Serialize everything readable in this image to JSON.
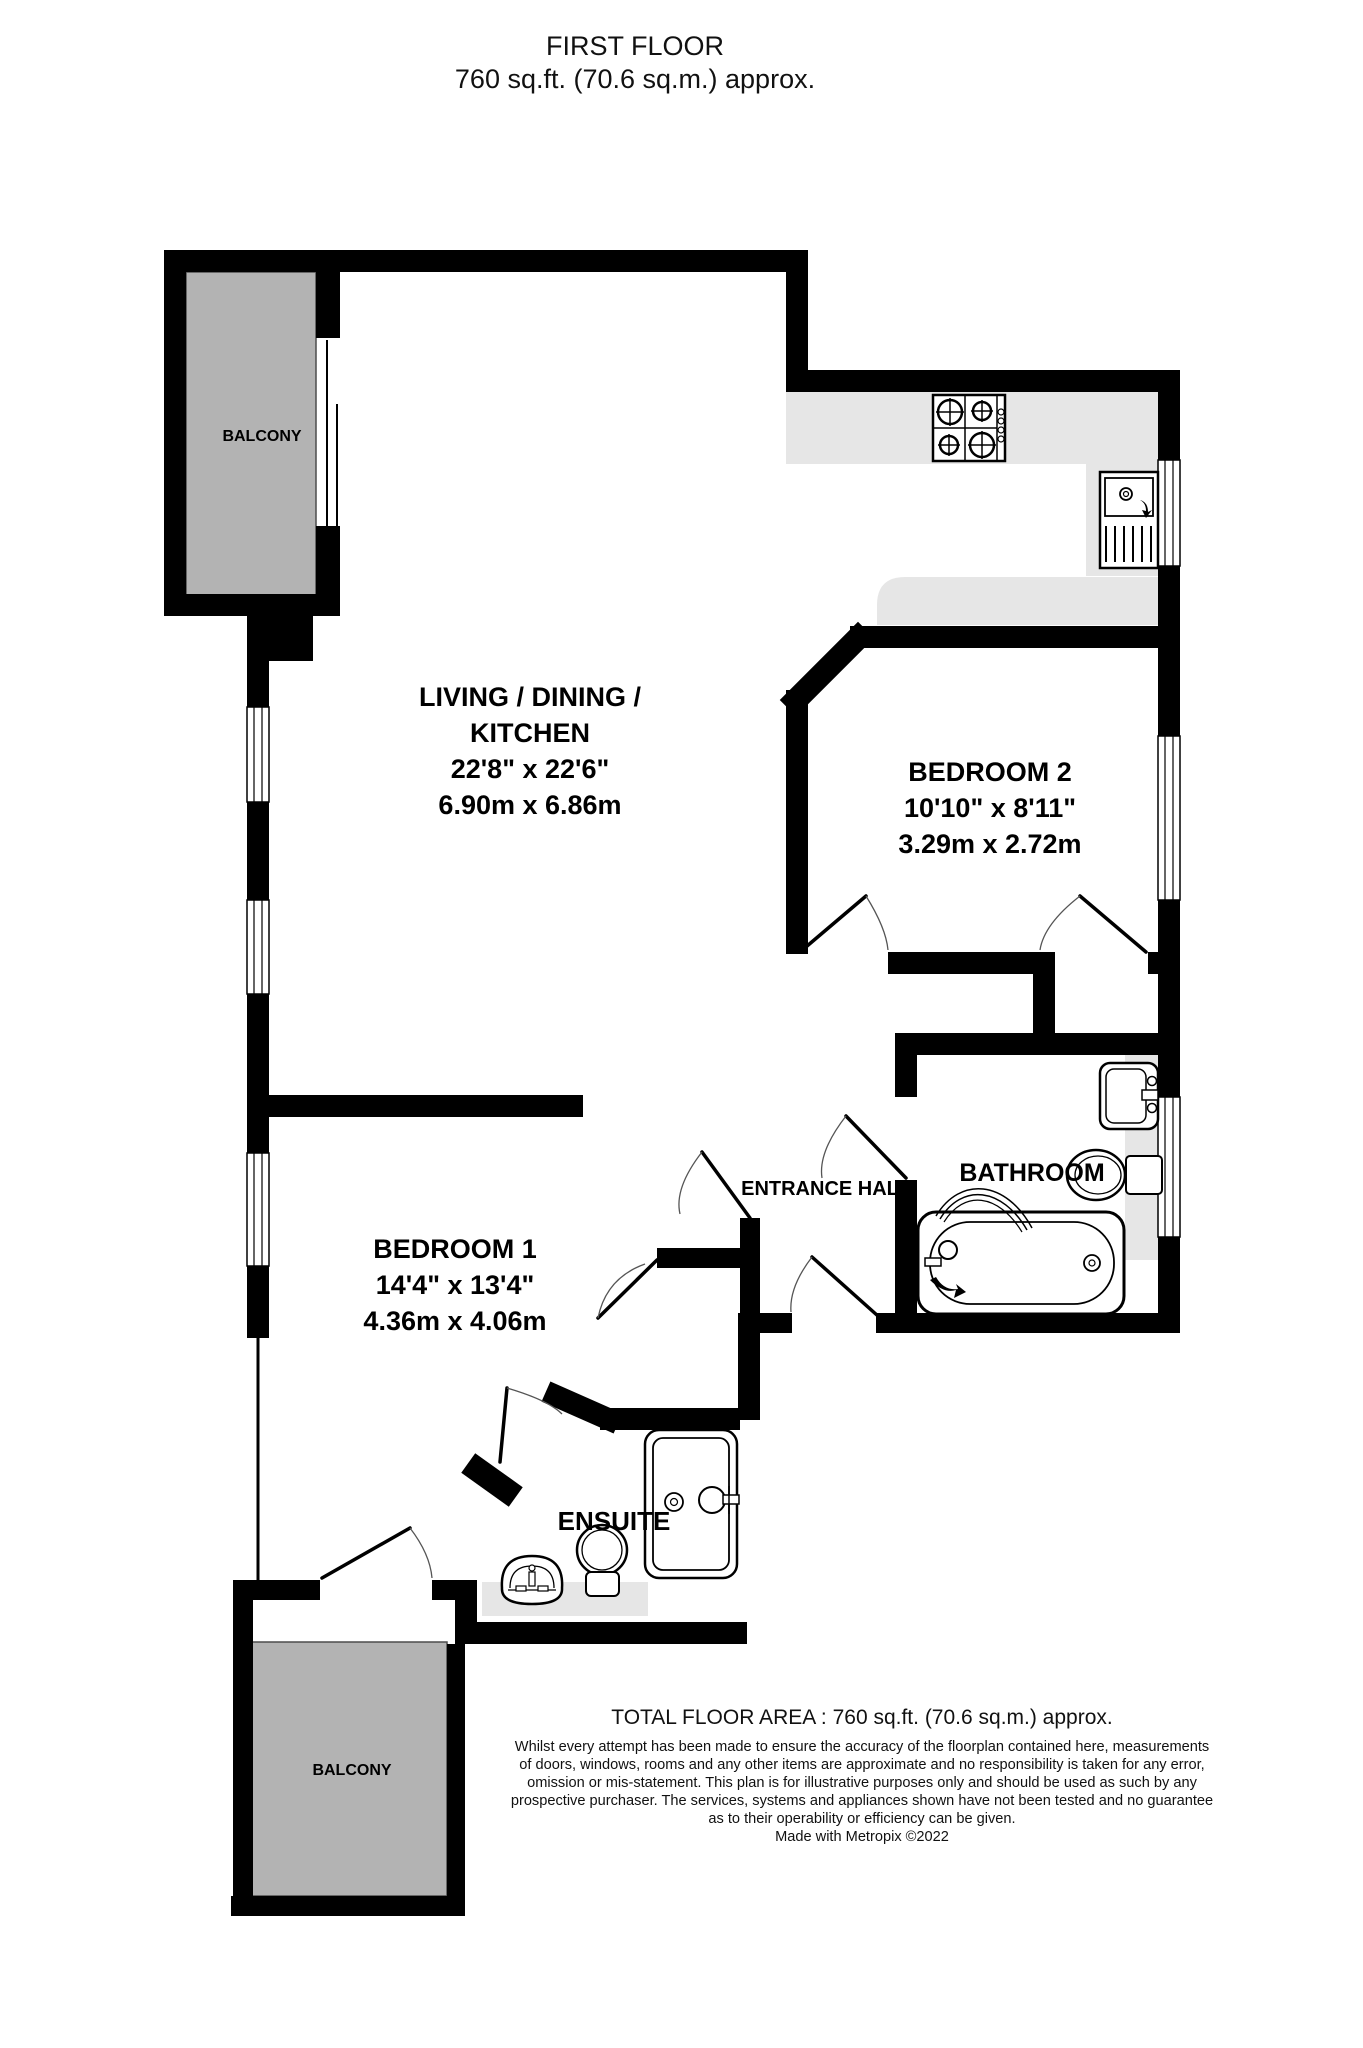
{
  "title": {
    "line1": "FIRST FLOOR",
    "line2": "760 sq.ft. (70.6 sq.m.) approx."
  },
  "rooms": {
    "living": {
      "name_line1": "LIVING / DINING /",
      "name_line2": "KITCHEN",
      "imperial": "22'8\"  x 22'6\"",
      "metric": "6.90m  x 6.86m"
    },
    "bedroom2": {
      "name": "BEDROOM 2",
      "imperial": "10'10\"  x 8'11\"",
      "metric": "3.29m  x 2.72m"
    },
    "bedroom1": {
      "name": "BEDROOM 1",
      "imperial": "14'4\"  x 13'4\"",
      "metric": "4.36m  x 4.06m"
    },
    "bathroom": {
      "name": "BATHROOM"
    },
    "entrance_hall": {
      "name": "ENTRANCE HAL"
    },
    "ensuite": {
      "name": "ENSUITE"
    },
    "balcony_top": {
      "name": "BALCONY"
    },
    "balcony_bottom": {
      "name": "BALCONY"
    }
  },
  "footer": {
    "total_area": "TOTAL FLOOR AREA : 760 sq.ft. (70.6 sq.m.) approx.",
    "disclaimer_lines": [
      "Whilst every attempt has been made to ensure the accuracy of the floorplan contained here, measurements",
      "of doors, windows, rooms and any other items are approximate and no responsibility is taken for any error,",
      "omission or mis-statement. This plan is for illustrative purposes only and should be used as such by any",
      "prospective purchaser. The services, systems and appliances shown have not been tested and no guarantee",
      "as to their operability or efficiency can be given."
    ],
    "credit": "Made with Metropix ©2022"
  },
  "colors": {
    "wall": "#000000",
    "balcony_fill": "#b3b3b3",
    "counter_fill": "#e6e6e6",
    "text": "#000000"
  }
}
